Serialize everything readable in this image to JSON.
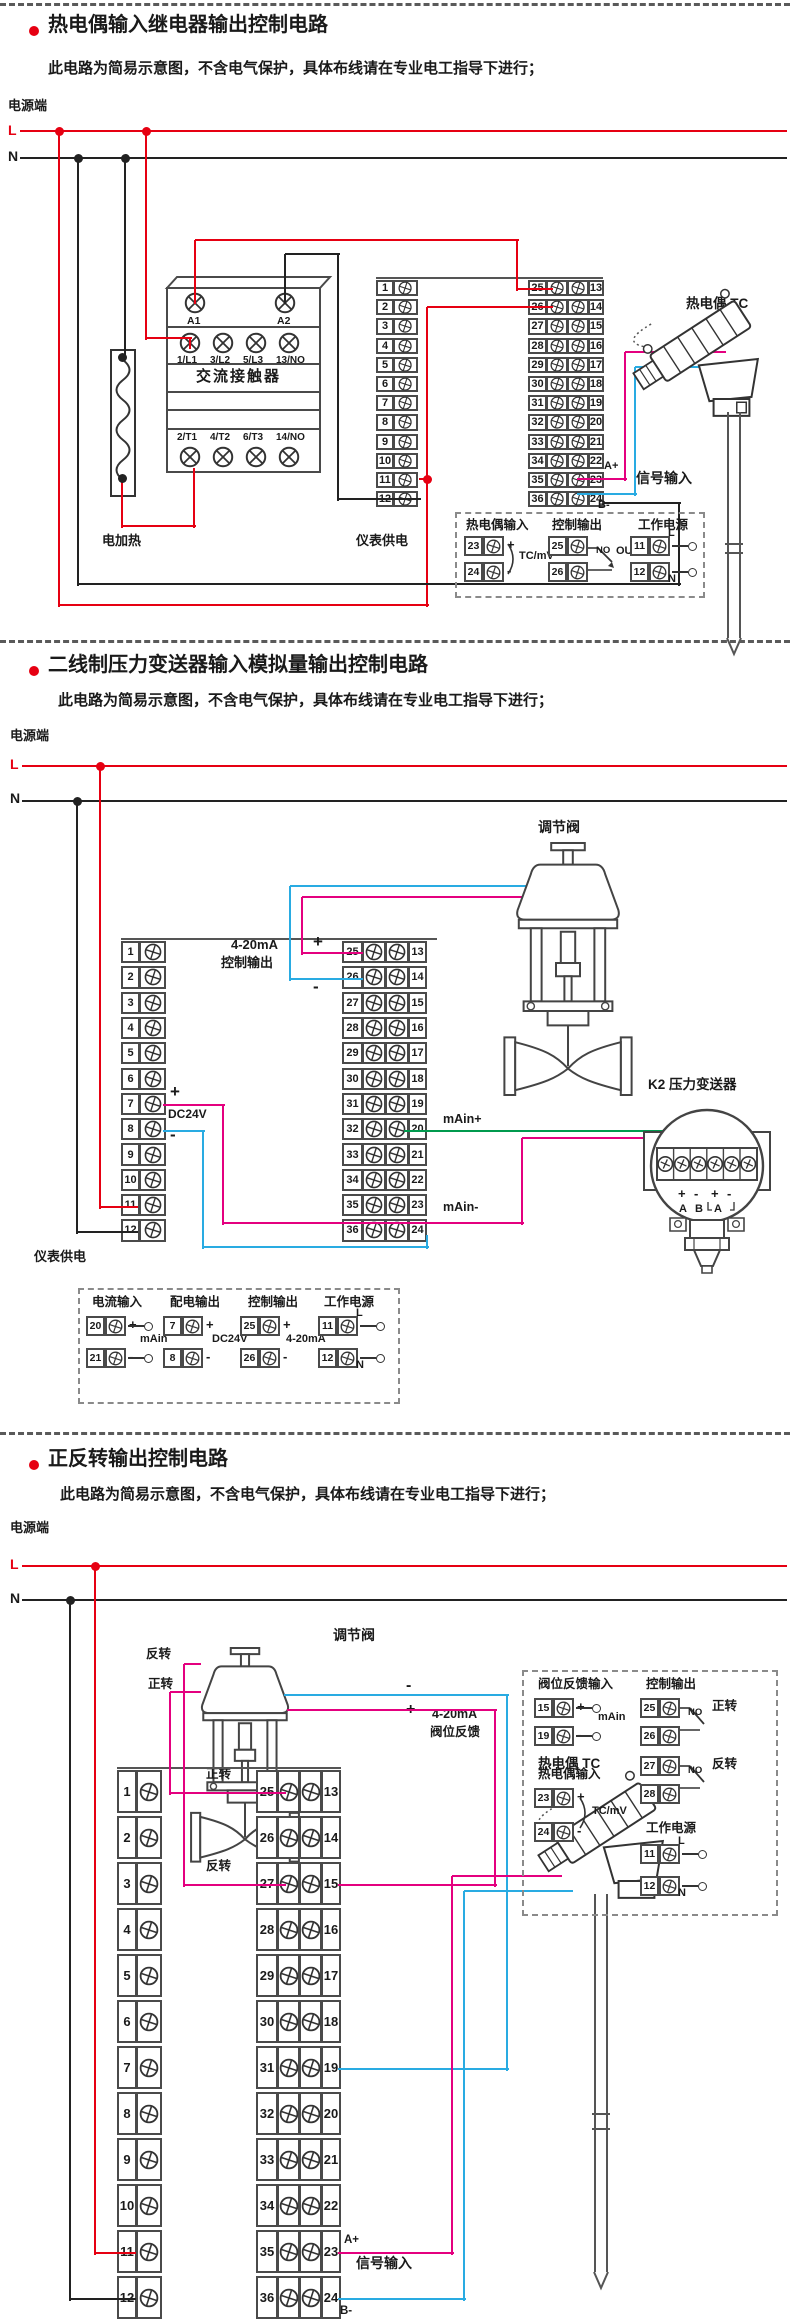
{
  "page": {
    "width": 790,
    "height": 2323,
    "background": "#ffffff"
  },
  "colors": {
    "bullet": "#e60012",
    "live_wire": "#e60012",
    "neutral_wire": "#222222",
    "signal_pink": "#e4007f",
    "signal_blue": "#29abe2",
    "signal_green": "#009a4e",
    "frame": "#4a4a4a"
  },
  "sections": [
    {
      "title": "热电偶输入继电器输出控制电路",
      "subtitle": "此电路为简易示意图，不含电气保护，具体布线请在专业电工指导下进行；",
      "power": {
        "side_label": "电源端",
        "live": "L",
        "neutral": "N"
      },
      "contactor": {
        "name": "交流接触器",
        "coil_terminals": [
          "A1",
          "A2"
        ],
        "line_terminals": [
          "1/L1",
          "3/L2",
          "5/L3",
          "13/NO"
        ],
        "load_terminals": [
          "2/T1",
          "4/T2",
          "6/T3",
          "14/NO"
        ]
      },
      "heater_label": "电加热",
      "supply_label": "仪表供电",
      "meter": {
        "left": [
          1,
          2,
          3,
          4,
          5,
          6,
          7,
          8,
          9,
          10,
          11,
          12
        ],
        "inner": [
          25,
          26,
          27,
          28,
          29,
          30,
          31,
          32,
          33,
          34,
          35,
          36
        ],
        "outer": [
          13,
          14,
          15,
          16,
          17,
          18,
          19,
          20,
          21,
          22,
          23,
          24
        ]
      },
      "sensor": {
        "name": "热电偶 TC",
        "wire_pos": "A+",
        "wire_neg": "B-",
        "signal": "信号输入"
      },
      "detail": {
        "g1": {
          "title": "热电偶输入",
          "t1": "23",
          "s1": "+",
          "t2": "24",
          "s2": "-",
          "note": "TC/mV"
        },
        "g2": {
          "title": "控制输出",
          "t1": "25",
          "t2": "26",
          "no": "NO",
          "out": "OUT"
        },
        "g3": {
          "title": "工作电源",
          "t1": "11",
          "s1": "L",
          "t2": "12",
          "s2": "N"
        }
      }
    },
    {
      "title": "二线制压力变送器输入模拟量输出控制电路",
      "subtitle": "此电路为简易示意图，不含电气保护，具体布线请在专业电工指导下进行；",
      "power": {
        "side_label": "电源端",
        "live": "L",
        "neutral": "N"
      },
      "valve_label": "调节阀",
      "transmitter": {
        "name": "K2  压力变送器",
        "signs": [
          "+",
          "-",
          "+",
          "-"
        ],
        "letters": [
          "A",
          "B",
          "A"
        ]
      },
      "labels": {
        "range": "4-20mA",
        "out_name": "控制输出",
        "plus": "+",
        "minus": "-",
        "dc": "DC24V",
        "main_plus": "mAin+",
        "main_minus": "mAin-",
        "supply": "仪表供电"
      },
      "meter": {
        "left": [
          1,
          2,
          3,
          4,
          5,
          6,
          7,
          8,
          9,
          10,
          11,
          12
        ],
        "inner": [
          25,
          26,
          27,
          28,
          29,
          30,
          31,
          32,
          33,
          34,
          35,
          36
        ],
        "outer": [
          13,
          14,
          15,
          16,
          17,
          18,
          19,
          20,
          21,
          22,
          23,
          24
        ]
      },
      "detail": {
        "g1": {
          "title": "电流输入",
          "t1": "20",
          "s1": "+",
          "t2": "21",
          "s2": "-",
          "note": "mAin"
        },
        "g2": {
          "title": "配电输出",
          "t1": "7",
          "s1": "+",
          "t2": "8",
          "s2": "-",
          "note": "DC24V"
        },
        "g3": {
          "title": "控制输出",
          "t1": "25",
          "s1": "+",
          "t2": "26",
          "s2": "-",
          "note": "4-20mA"
        },
        "g4": {
          "title": "工作电源",
          "t1": "11",
          "s1": "L",
          "t2": "12",
          "s2": "N"
        }
      }
    },
    {
      "title": "正反转输出控制电路",
      "subtitle": "此电路为简易示意图，不含电气保护，具体布线请在专业电工指导下进行；",
      "power": {
        "side_label": "电源端",
        "live": "L",
        "neutral": "N"
      },
      "valve_label": "调节阀",
      "labels": {
        "fwd": "正转",
        "rev": "反转",
        "fb_range": "4-20mA",
        "fb_name": "阀位反馈",
        "plus": "+",
        "minus": "-"
      },
      "sensor": {
        "name": "热电偶 TC",
        "wire_pos": "A+",
        "wire_neg": "B-",
        "signal": "信号输入"
      },
      "meter": {
        "left": [
          1,
          2,
          3,
          4,
          5,
          6,
          7,
          8,
          9,
          10,
          11,
          12
        ],
        "inner": [
          25,
          26,
          27,
          28,
          29,
          30,
          31,
          32,
          33,
          34,
          35,
          36
        ],
        "outer": [
          13,
          14,
          15,
          16,
          17,
          18,
          19,
          20,
          21,
          22,
          23,
          24
        ]
      },
      "detail": {
        "g1": {
          "title": "阀位反馈输入",
          "t1": "15",
          "s1": "+",
          "t2": "19",
          "s2": "-",
          "note": "mAin"
        },
        "g2": {
          "title": "控制输出",
          "rows": [
            "25",
            "26",
            "27",
            "28"
          ],
          "no": "NO",
          "fwd": "正转",
          "rev": "反转"
        },
        "g3": {
          "title": "热电偶输入",
          "t1": "23",
          "s1": "+",
          "t2": "24",
          "s2": "-",
          "note": "TC/mV"
        },
        "g4": {
          "title": "工作电源",
          "t1": "11",
          "s1": "L",
          "t2": "12",
          "s2": "N"
        }
      }
    }
  ]
}
